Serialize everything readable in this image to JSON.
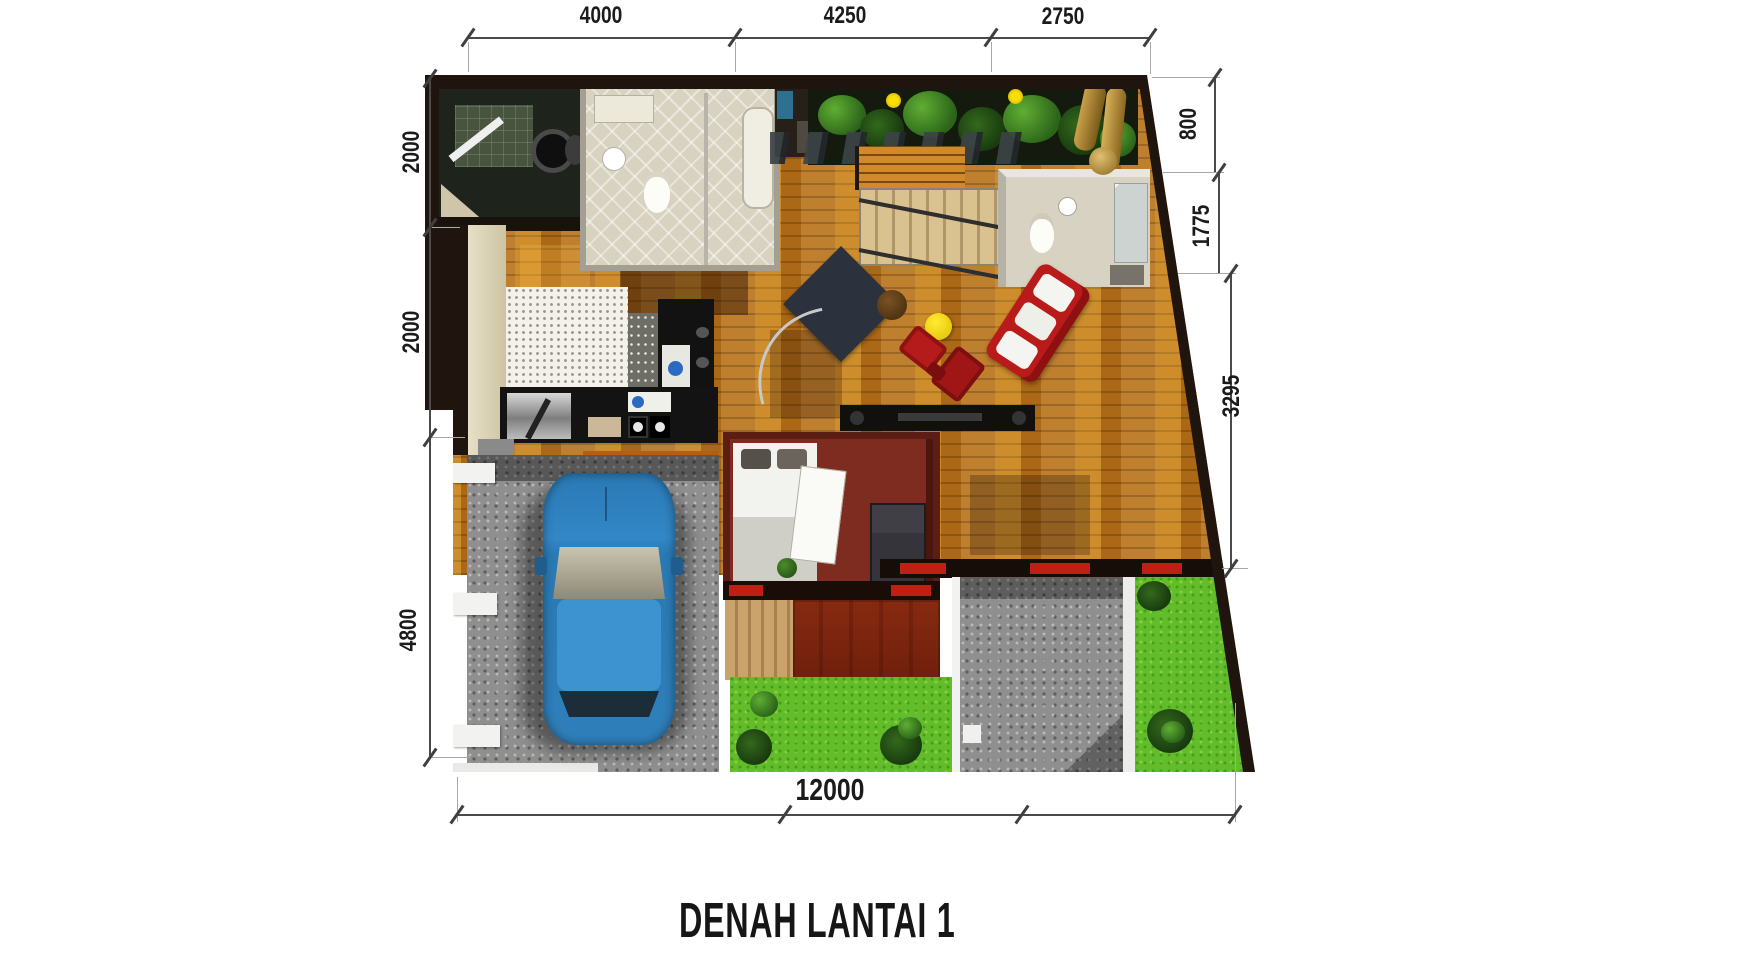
{
  "title": "DENAH LANTAI 1",
  "dimensions": {
    "top": [
      "4000",
      "4250",
      "2750"
    ],
    "left": [
      "2000",
      "2000",
      "4800"
    ],
    "right": [
      "800",
      "1775",
      "3295"
    ],
    "bottom": [
      "12000"
    ]
  },
  "palette": {
    "background": "#ffffff",
    "outer_wall": "#1f150e",
    "wood_floor": "#b9741c",
    "kitchen_floor": "#f3f1e9",
    "bedroom_wall": "#7e2c20",
    "sofa_red": "#bb1d1d",
    "grass_green": "#63bd2b",
    "paving_gray": "#8f8f8f",
    "car_blue": "#2a79b4",
    "garden_foliage": "#3f7d22",
    "deck_tan": "#c9a36b",
    "dimension_ink": "#1b1b1b"
  }
}
